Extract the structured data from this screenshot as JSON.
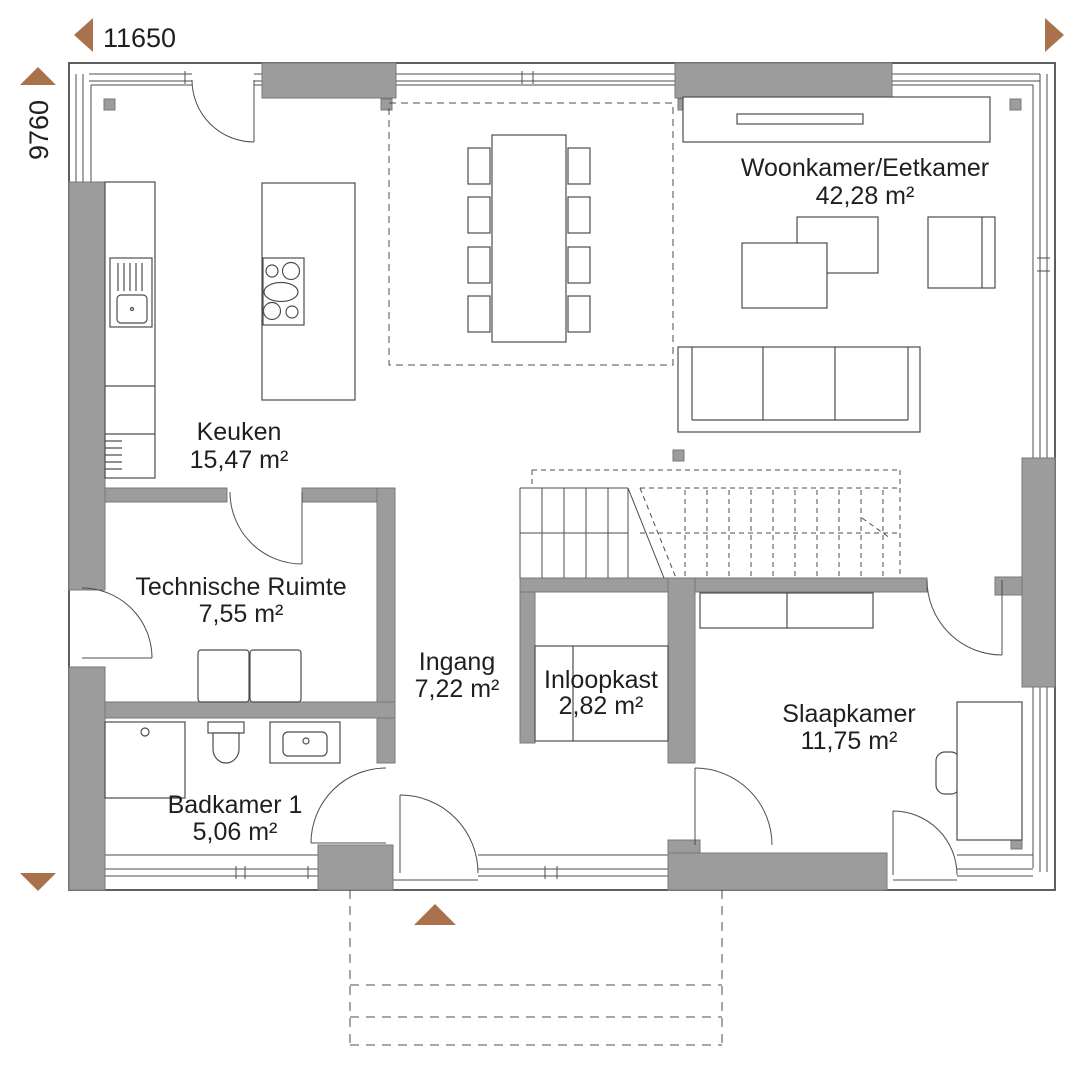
{
  "title": "Floor plan ground floor",
  "colors": {
    "wall": "#9c9c9c",
    "wall_stroke": "#787878",
    "line": "#4d4d4d",
    "text": "#1f1f1f",
    "arrow": "#a9724c"
  },
  "dimensions": {
    "width": "11650",
    "height": "9760"
  },
  "rooms": [
    {
      "name": "Woonkamer/Eetkamer",
      "area": "42,28 m²"
    },
    {
      "name": "Keuken",
      "area": "15,47 m²"
    },
    {
      "name": "Technische Ruimte",
      "area": "7,55 m²"
    },
    {
      "name": "Ingang",
      "area": "7,22 m²"
    },
    {
      "name": "Inloopkast",
      "area": "2,82 m²"
    },
    {
      "name": "Slaapkamer",
      "area": "11,75 m²"
    },
    {
      "name": "Badkamer 1",
      "area": "5,06 m²"
    }
  ]
}
